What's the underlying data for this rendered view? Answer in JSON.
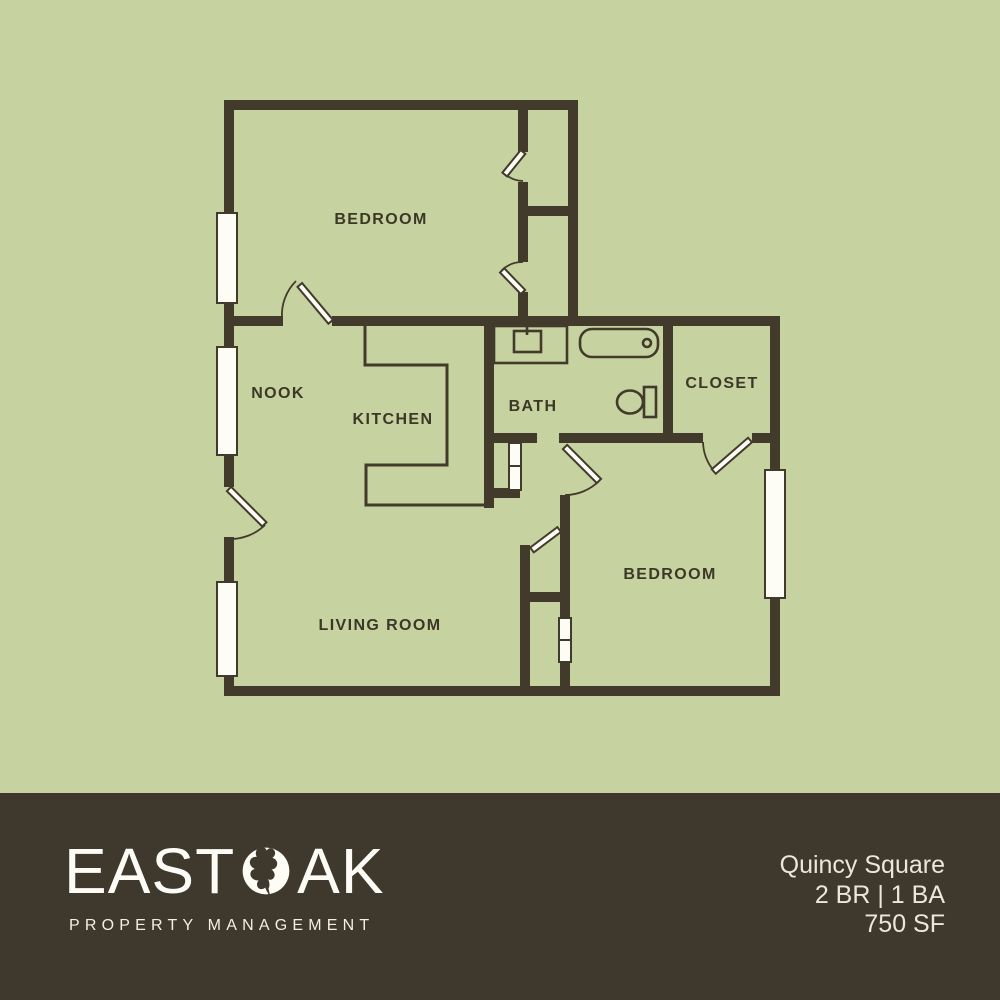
{
  "plan": {
    "rooms": [
      {
        "id": "bedroom-upper",
        "label": "BEDROOM"
      },
      {
        "id": "nook",
        "label": "NOOK"
      },
      {
        "id": "kitchen",
        "label": "KITCHEN"
      },
      {
        "id": "bath",
        "label": "BATH"
      },
      {
        "id": "closet",
        "label": "CLOSET"
      },
      {
        "id": "bedroom-lower",
        "label": "BEDROOM"
      },
      {
        "id": "living-room",
        "label": "LIVING ROOM"
      }
    ]
  },
  "footer": {
    "brand": {
      "name_left": "EAST",
      "name_right": "AK",
      "o_icon": "oak-leaf-in-circle",
      "tagline": "PROPERTY MANAGEMENT"
    },
    "listing": {
      "name": "Quincy Square",
      "config": "2 BR | 1 BA",
      "area": "750 SF"
    }
  },
  "colors": {
    "background_green": "#c7d2a1",
    "wall_brown": "#423a2a",
    "footer_brown": "#3e382d",
    "cream_text": "#ece7da",
    "white": "#fdfdf6"
  }
}
